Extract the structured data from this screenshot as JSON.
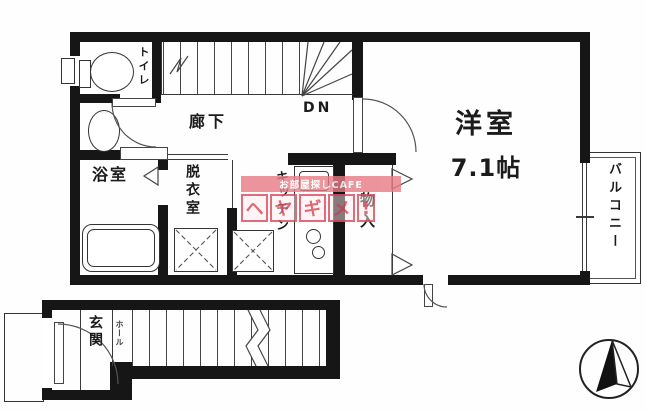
{
  "floorplan": {
    "rooms": {
      "western_room": {
        "name": "洋室",
        "size": "7.1帖"
      },
      "balcony": "バルコニー",
      "toilet": "トイレ",
      "hallway": "廊下",
      "bathroom": "浴室",
      "dressing_room": "脱衣室",
      "kitchen": "キッチン",
      "storage": "物入",
      "entrance": "玄関",
      "entry_hall": "ホール"
    },
    "stairs": {
      "down_label": "DN"
    },
    "watermark": {
      "tagline": "お部屋探しCAFE",
      "brand": [
        "ヘ",
        "ヤ",
        "ギ",
        "メ"
      ],
      "brand_suffix": "!"
    },
    "colors": {
      "wall": "#161616",
      "watermark_pink": "#db4d5c"
    }
  }
}
